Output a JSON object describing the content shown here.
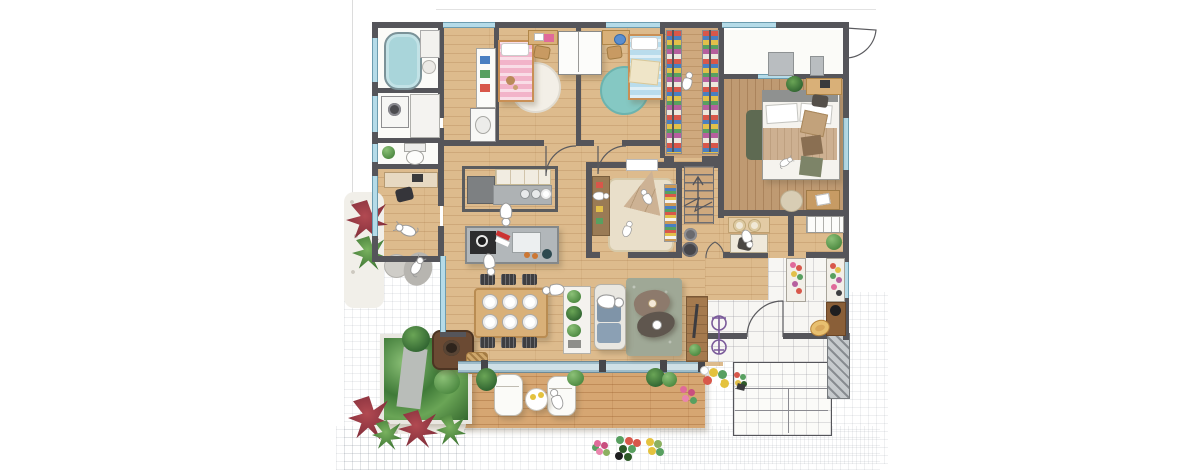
{
  "scene": {
    "kind": "hand-drawn watercolor architectural floor plan",
    "view": "top-down plan of a single-storey house with garden, wood deck and entrance court",
    "visible_text": ""
  },
  "palette": {
    "wall": "#55555a",
    "wood": "#ddbb8d",
    "wood_mid": "#cfa97e",
    "wood_dark": "#bf9a72",
    "wood_deck": "#d6a672",
    "tile": "#f7f6f3",
    "window": "#b5dbe8",
    "tub": "#a9d5da",
    "pink": "#f2b3c9",
    "blue_bed": "#b9dcec",
    "teal_rug": "#85c8c3",
    "white_rug": "#f3efe7",
    "sage": "#9fa896",
    "beige_rug": "#e9dfca",
    "teepee": "#cdb294",
    "tan": "#d9b078",
    "counter": "#b2b7ba",
    "appliance": "#2d2d2f",
    "chair_dark": "#3e3e41",
    "green": "#69a258",
    "red_plant": "#9c3742",
    "pink_flower": "#e06a9a",
    "yellow": "#e4c23e",
    "purple": "#7a5a9a",
    "brown": "#9a7b55",
    "hat": "#d9a85c",
    "porch_gray": "#b9bdc0"
  },
  "rooms": {
    "bathroom": "Bathroom with bathtub",
    "laundry": "Laundry / washroom",
    "toilet": "Toilet",
    "study": "Study nook",
    "corridor": "Corridor with washbasin",
    "kids1": "Kids bedroom 1 (pink bed)",
    "kids2": "Kids bedroom 2 (blue bed)",
    "wic": "Walk-in closet",
    "master": "Master bedroom",
    "playroom": "Playroom with teepee",
    "stairs": "Staircase",
    "kitchen": "Kitchen with island",
    "dining": "Dining area",
    "living": "Living area",
    "nook": "Work nook / pantry",
    "entrance": "Entrance hall",
    "porch": "Porch / balcony",
    "deck": "Wood deck",
    "garden": "Planted garden bed",
    "patio": "Paved patio",
    "steps": "Entrance steps"
  },
  "furniture": [
    "bathtub",
    "washing-machine",
    "toilet-bowl",
    "washbasin",
    "single-bed-pink",
    "single-bed-blue",
    "round-rug-white",
    "round-rug-teal",
    "study-desks",
    "wardrobe",
    "clothes-racks",
    "double-bed",
    "bedside-table",
    "kitchen-counter",
    "kitchen-island",
    "dining-table-6-plates",
    "sofa",
    "tv-board",
    "bean-shaped-tables",
    "area-rug",
    "teepee-tent",
    "bookshelf",
    "toy-shelf",
    "ottomans",
    "work-desk",
    "shoe-benches",
    "bench-with-hat",
    "bicycle",
    "loungers",
    "deck-table",
    "fire-pit",
    "basket",
    "flower-pots"
  ],
  "figures": [
    "cooking-person",
    "dining-people",
    "sofa-person",
    "deck-person",
    "playroom-kids",
    "closet-person",
    "nook-person",
    "dog-on-cushion",
    "dog-in-study",
    "cat-on-bed"
  ]
}
